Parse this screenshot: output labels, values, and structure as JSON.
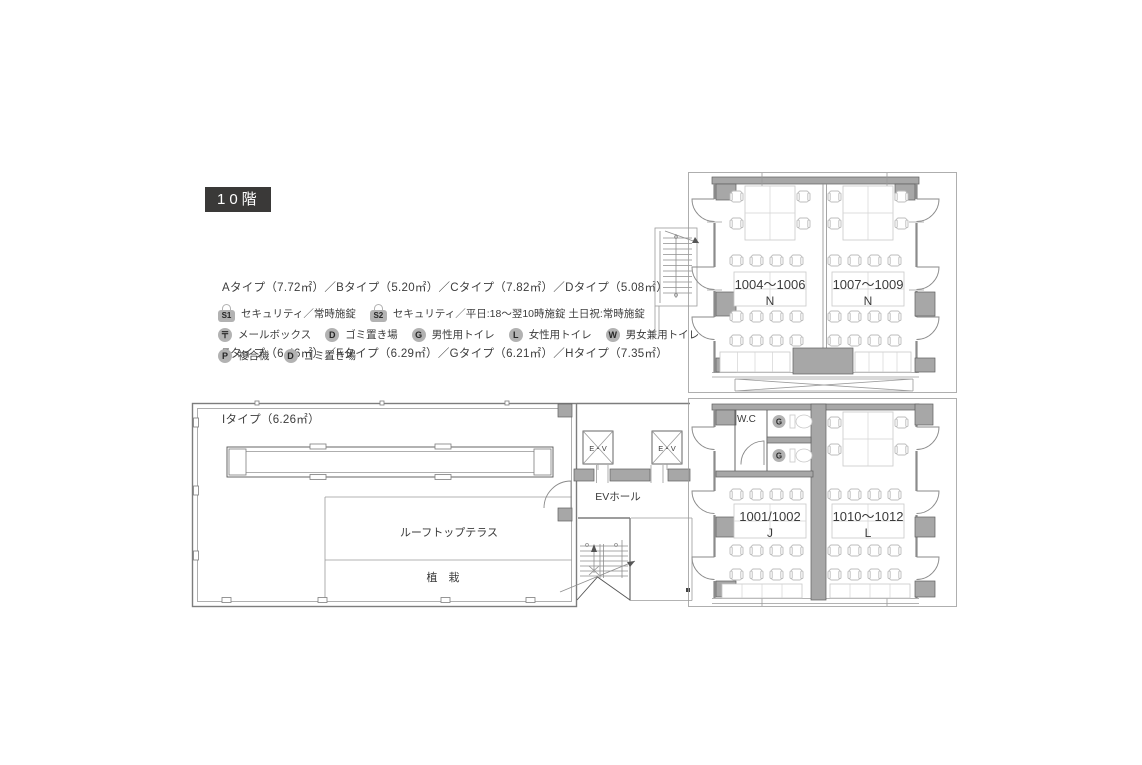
{
  "header": {
    "floor_label": "10階"
  },
  "unit_types": {
    "line1": "Aタイプ（7.72㎡）／Bタイプ（5.20㎡）／Cタイプ（7.82㎡）／Dタイプ（5.08㎡）",
    "line2": "Eタイプ（6.46㎡）／Fタイプ（6.29㎡）／Gタイプ（6.21㎡）／Hタイプ（7.35㎡）",
    "line3": "Iタイプ（6.26㎡）"
  },
  "legend": {
    "s1": {
      "badge": "S1",
      "label": "セキュリティ／常時施錠"
    },
    "s2": {
      "badge": "S2",
      "label": "セキュリティ／平日:18～翌10時施錠 土日祝:常時施錠"
    },
    "mail": {
      "badge": "〒",
      "label": "メールボックス"
    },
    "trash1": {
      "badge": "D",
      "label": "ゴミ置き場"
    },
    "mens": {
      "badge": "G",
      "label": "男性用トイレ"
    },
    "womens": {
      "badge": "L",
      "label": "女性用トイレ"
    },
    "unisex": {
      "badge": "W",
      "label": "男女兼用トイレ"
    },
    "copier": {
      "badge": "P",
      "label": "複合機"
    },
    "trash2": {
      "badge": "D",
      "label": "ゴミ置き場"
    }
  },
  "plan": {
    "rooms": {
      "room_1004": {
        "number": "1004～1006",
        "type": "N"
      },
      "room_1007": {
        "number": "1007～1009",
        "type": "N"
      },
      "room_1001": {
        "number": "1001/1002",
        "type": "J"
      },
      "room_1010": {
        "number": "1010～1012",
        "type": "L"
      }
    },
    "labels": {
      "wc": "W.C",
      "ev": "E・V",
      "ev_hall": "EVホール",
      "terrace": "ルーフトップテラス",
      "planting": "植　栽",
      "toilet_badge": "G"
    }
  },
  "colors": {
    "accent_dark": "#3a3938",
    "wall_gray": "#a7a7a7",
    "badge_gray": "#b2b2b2"
  }
}
